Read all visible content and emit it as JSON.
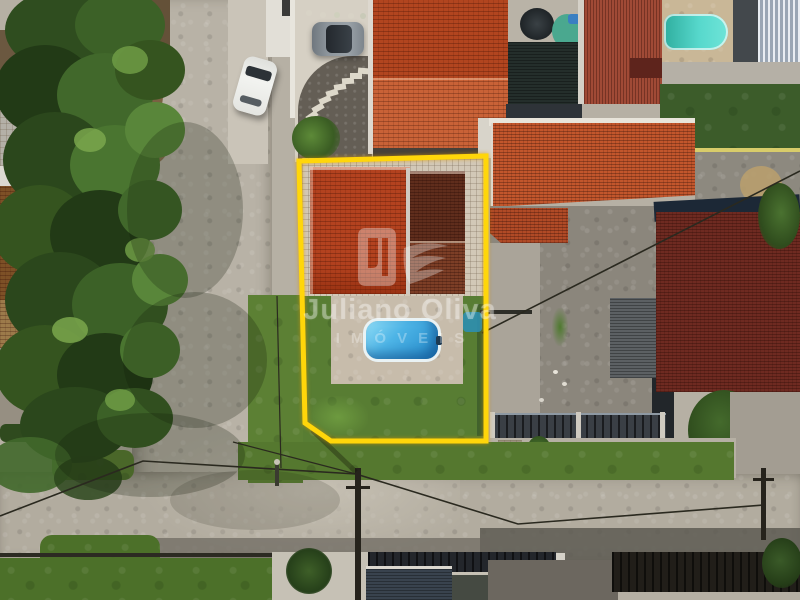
{
  "scene": {
    "kind": "aerial-drone-photo",
    "subject": "Top-down drone view of a corner lot outlined in yellow: house with orange tile roof, paved patio, rectangular swimming pool and lawn, beside a gravel road intersection with neighboring tile-roof houses, a second turquoise pool, parked cars and trees"
  },
  "watermark": {
    "line1": "Juliano Oliva",
    "line2": "IMÓVEIS"
  },
  "colors": {
    "boundary_yellow": "#ffd60a",
    "watermark_white": "#ffffff",
    "pool_blue": "#3fa9e0",
    "neighbor_pool_teal": "#3ecfc4",
    "roof_orange_bright": "#c0512a",
    "roof_maroon": "#6e2a21",
    "lawn_green": "#5a7d35",
    "road_gravel": "#b6b0a4"
  }
}
